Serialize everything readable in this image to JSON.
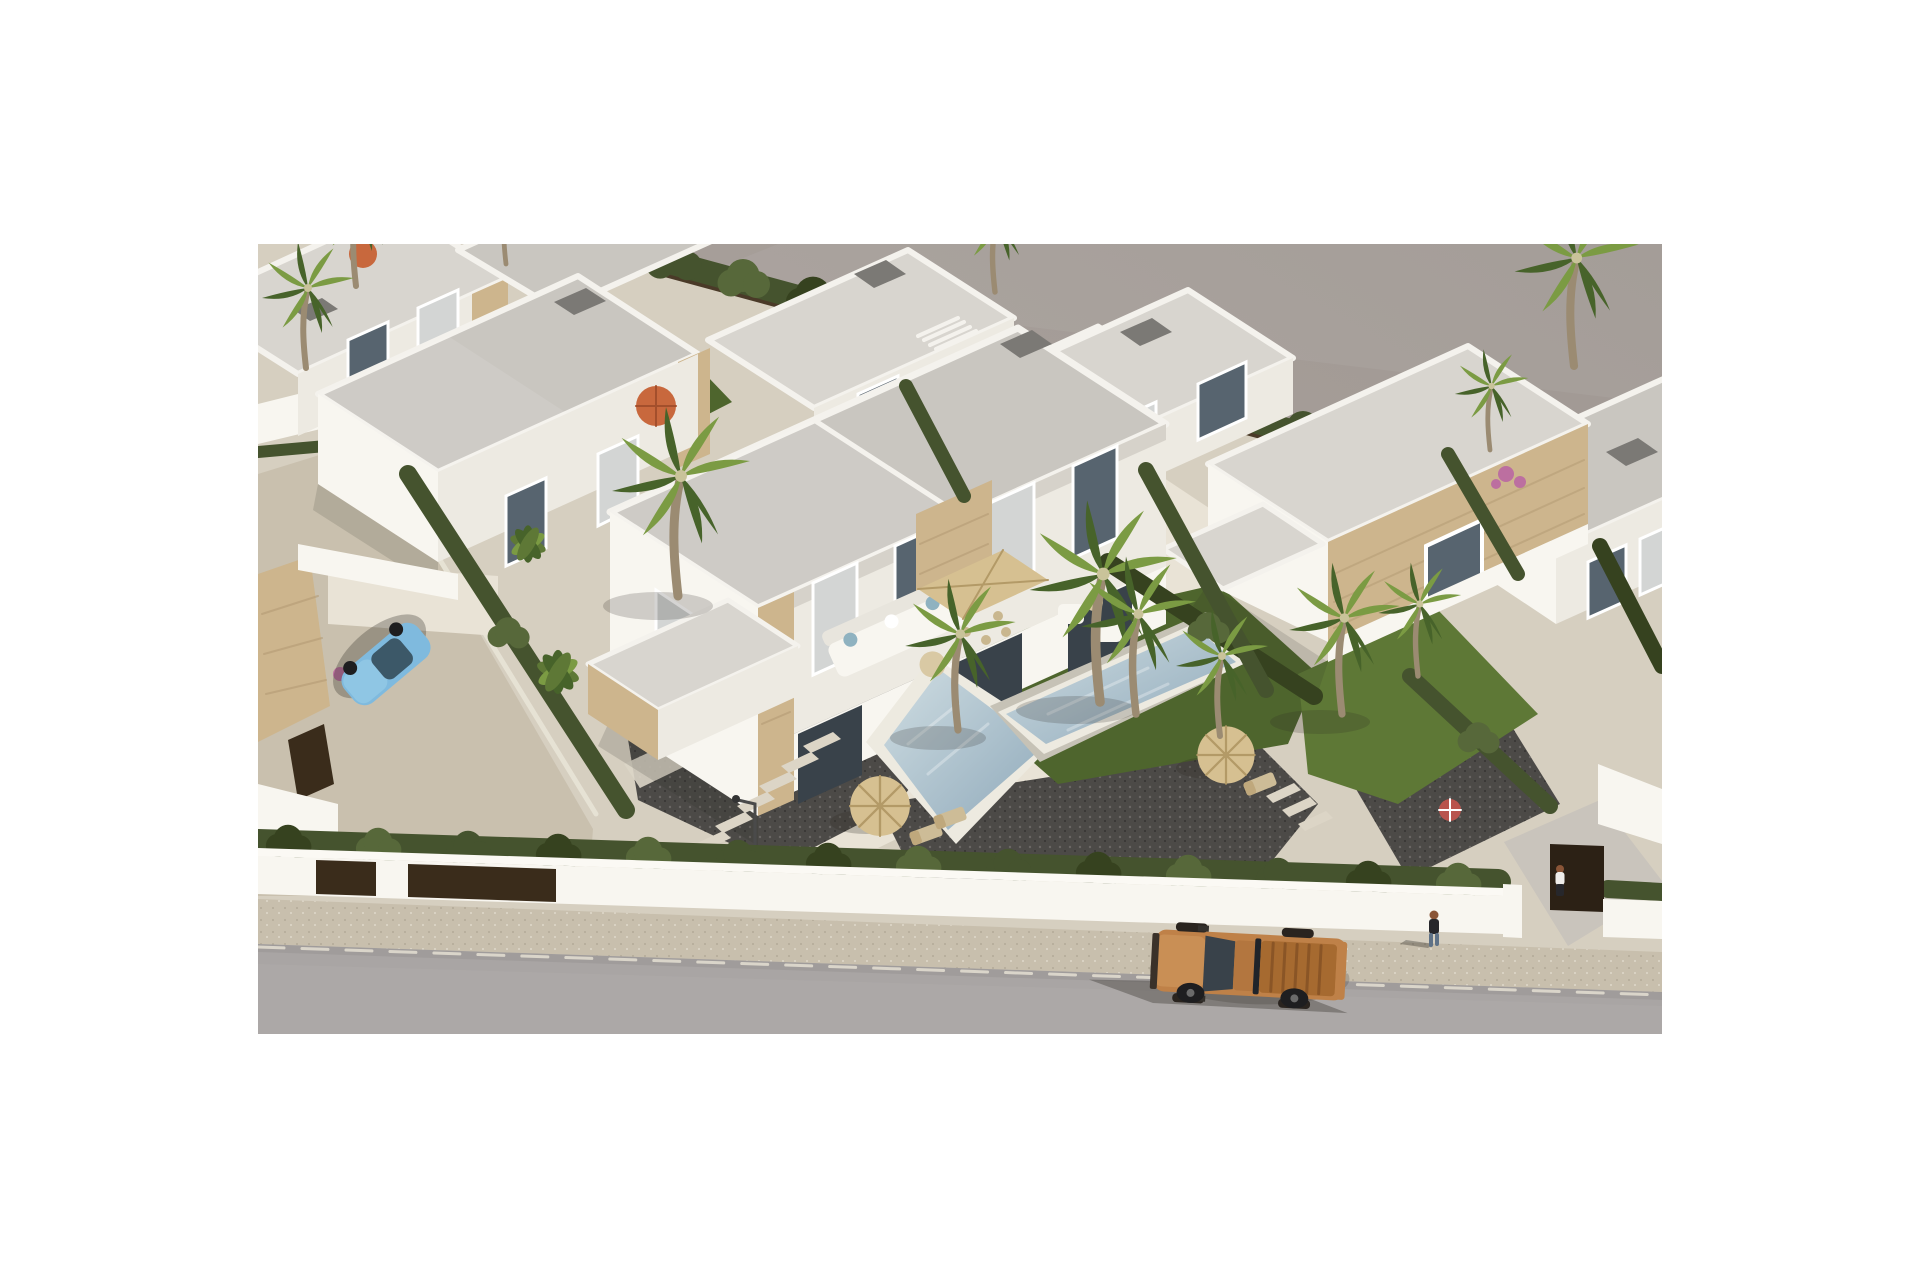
{
  "meta": {
    "type": "architectural-aerial-render",
    "description": "Aerial 3D render of a modern white villa development: flat-roofed duplex villas with sandstone accents, dark gravel and lawn gardens, swimming pools, palm trees and cypress hedges, a white perimeter wall along a beige sidewalk, a grey road with a copper pickup truck, a light-blue parked car and two pedestrians, all on a plain grey backdrop."
  },
  "photo": {
    "left": 258,
    "top": 244,
    "width": 1404,
    "height": 790
  },
  "scene": {
    "buildings": 10,
    "pools": 2,
    "people": 2,
    "vehicles": [
      {
        "name": "pickup-truck",
        "color_key": "truck_body",
        "location": "road bottom center"
      },
      {
        "name": "parked-car",
        "color_key": "car_body",
        "location": "left street"
      }
    ],
    "vegetation": [
      "palm trees",
      "cypress hedges",
      "lawns",
      "pink bougainvillea"
    ],
    "furniture": [
      "straw parasols",
      "square beige parasol",
      "corner sofa",
      "sun loungers",
      "dining set"
    ]
  },
  "palette": {
    "page_bg": "#ffffff",
    "backdrop_a": "#b1a9a4",
    "backdrop_b": "#a09893",
    "ground_base": "#d6cfc0",
    "street": "#c9c0ae",
    "sidewalk": "#c8bfad",
    "road": "#a9a5a4",
    "curb_white": "#e8e3d6",
    "wall_sun": "#f8f6f0",
    "wall_mid": "#edeae2",
    "wall_shade": "#ddd8ce",
    "parapet": "#f4f2ed",
    "roof": "#c9c6c0",
    "roof_light": "#d8d5cf",
    "chimney": "#7b7975",
    "stone": "#cdb58d",
    "stone_dark": "#b49b74",
    "window": "#57646f",
    "curtain": "#d3d5d4",
    "glass": "#39424a",
    "hedge": "#45532e",
    "hedge_dark": "#36421f",
    "hedge_light": "#57683a",
    "lawn": "#4e652d",
    "lawn_light": "#5e7836",
    "palm_light": "#7b9b43",
    "palm_dark": "#47632a",
    "trunk": "#9b8b72",
    "gravel": "#4c4a47",
    "terrace": "#e9e3d6",
    "path": "#dcd5c6",
    "deck": "#c6c2b6",
    "pool_rim": "#edeae0",
    "pool_deep": "#8fa9ba",
    "pool_light": "#cfdde2",
    "parasol": "#d6c091",
    "parasol_line": "#b39a67",
    "orange_umbrella": "#c8683d",
    "red_parasol": "#b9544d",
    "flower_pink": "#bc6fa0",
    "flower_red": "#b35949",
    "truck_body": "#bf8148",
    "truck_hood": "#c98f55",
    "truck_cab": "#b3763f",
    "truck_bed": "#a66a30",
    "truck_plank": "#8a5526",
    "truck_grille": "#3a3129",
    "wheel": "#1e1e20",
    "car_body": "#7fbade",
    "car_hood": "#8fc6e4",
    "car_glass": "#3c5868",
    "gate": "#3a2c1b",
    "fence": "#4a3a28",
    "door_dark": "#2c2115",
    "shadow": "#2e2a24",
    "skin": "#8a5537",
    "fig_dark": "#27272b",
    "fig_shirt": "#efedea",
    "fig_pants": "#5f7287",
    "lamp": "#4a4a4a",
    "white": "#ffffff"
  }
}
